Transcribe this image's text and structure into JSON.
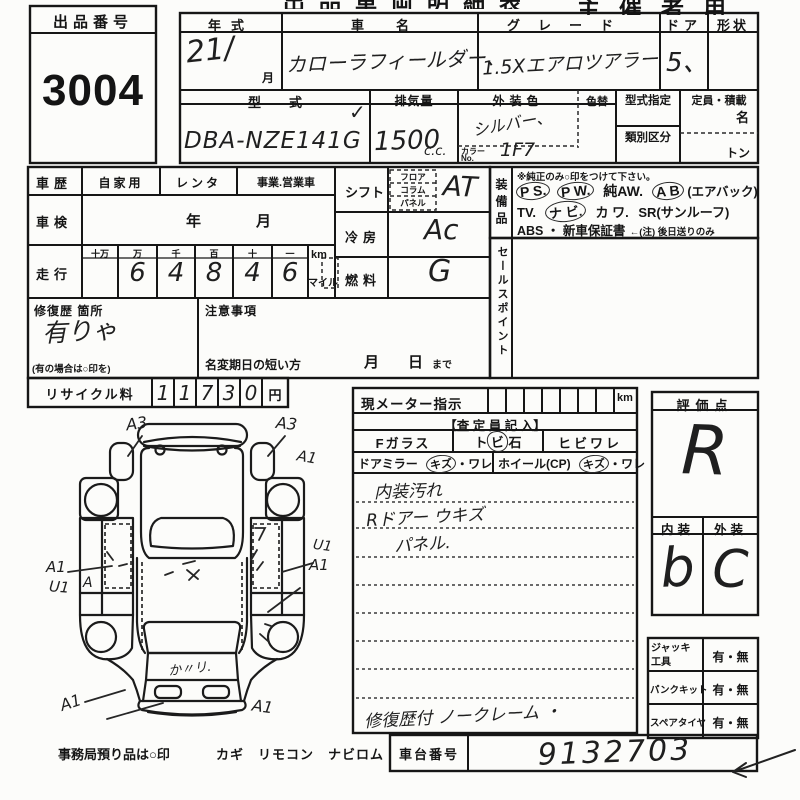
{
  "header": {
    "title_fragment": "出品車両明細表",
    "organizer_label": "主催者用",
    "exhibit": {
      "label": "出品番号",
      "number": "3004"
    }
  },
  "top": {
    "year": {
      "label": "年式",
      "value": "21/",
      "suffix": "月"
    },
    "car_name": {
      "label": "車名",
      "value": "カローラフィールダー、"
    },
    "grade": {
      "label": "グレード",
      "value": "1.5Xエアロツアラー"
    },
    "door": {
      "label": "ドア",
      "value": "5、"
    },
    "shape": {
      "label": "形状"
    },
    "model": {
      "label": "型式",
      "value": "DBA-NZE141G",
      "check": "✓"
    },
    "displacement": {
      "label": "排気量",
      "value": "1500",
      "unit": "c.c."
    },
    "ext_color": {
      "label": "外装色",
      "value": "シルバー、",
      "color_no_label_1": "カラー",
      "color_no_label_2": "No.",
      "color_no_value": "1F7"
    },
    "color_change": {
      "label": "色替"
    },
    "type_designation": {
      "label": "型式指定"
    },
    "class_division": {
      "label": "類別区分"
    },
    "capacity": {
      "label": "定員・積載",
      "persons": "名",
      "tons": "トン"
    }
  },
  "history": {
    "car_history": {
      "label": "車歴",
      "opt1": "自家用",
      "opt2": "レンタ",
      "opt3": "事業.営業車"
    },
    "inspection": {
      "label": "車検",
      "year": "年",
      "month": "月"
    },
    "mileage": {
      "label": "走行",
      "digit_labels": [
        "十万",
        "万",
        "千",
        "百",
        "十",
        "一"
      ],
      "digits": [
        "",
        "6",
        "4",
        "8",
        "4",
        "6"
      ],
      "unit_km": "km",
      "unit_mile": "マイル"
    },
    "repair": {
      "label": "修復歴 箇所",
      "value": "有りゃ",
      "note": "(有の場合は○印を)"
    },
    "caution": {
      "label": "注意事項",
      "deadline": "名変期日の短い方",
      "month": "月",
      "day": "日",
      "until": "まで"
    },
    "recycle": {
      "label": "リサイクル料",
      "digits": [
        "1",
        "1",
        "7",
        "3",
        "0"
      ],
      "unit": "円"
    }
  },
  "spec": {
    "shift": {
      "label": "シフト",
      "pos1": "フロア",
      "pos2": "コラム",
      "pos3": "パネル",
      "value": "AT"
    },
    "aircon": {
      "label": "冷房",
      "value": "Ac"
    },
    "fuel": {
      "label": "燃料",
      "value": "G"
    }
  },
  "equipment": {
    "label": "装備品",
    "note": "※純正のみ○印をつけて下さい。",
    "ps": "P S.",
    "pw": "P W.",
    "aw": "純AW.",
    "ab": "A B",
    "airbag": "(エアバック)",
    "tv": "TV.",
    "navi": "ナ ビ.",
    "kawa": "カ ワ.",
    "sr": "SR(サンルーフ)",
    "abs": "ABS ・ 新車保証書",
    "abs_note": "←(注) 後日送りのみ"
  },
  "sales_point": {
    "label": "セールスポイント"
  },
  "meter": {
    "label": "現メーター指示",
    "unit": "km",
    "inspector_header": "【査 定 員 記 入】",
    "f_glass": "Fガラス",
    "stone_pre": "ト",
    "stone_mid": "ビ",
    "stone_post": "石",
    "crack": "ヒビワレ",
    "mirror_label": "ドアミラー",
    "mirror_circled": "キズ",
    "mirror_rest": "・ワレ",
    "wheel_label": "ホイール(CP)",
    "wheel_circled": "キズ",
    "wheel_rest": "・ワレ",
    "note1": "内装汚れ",
    "note2": "Rドアー ウキズ",
    "note3": "パネル.",
    "bottom_note": "修復歴付 ノークレーム ・"
  },
  "chassis": {
    "label": "車台番号",
    "value": "9132703"
  },
  "evaluation": {
    "label": "評価点",
    "score": "R",
    "interior_label": "内装",
    "interior": "b",
    "exterior_label": "外装",
    "exterior": "C"
  },
  "accessories": {
    "jack": {
      "label": "ジャッキ工具",
      "value": "有・無"
    },
    "puncture": {
      "label": "パンクキット",
      "value": "有・無"
    },
    "spare": {
      "label": "スペアタイヤ",
      "value": "有・無"
    }
  },
  "diagram": {
    "a3_left": "A3",
    "a3_right": "A3",
    "a1_right_top": "A1",
    "a1_left": "A1",
    "u1_left": "U1",
    "a_sill": "A",
    "u1_right": "U1",
    "a1_right": "A1",
    "a1_bottom_left": "A1",
    "a1_bottom_right": "A1",
    "hatch_note": "か〃リ."
  },
  "footer": {
    "office_note": "事務局預り品は○印",
    "items": "カギ　リモコン　ナビロム"
  }
}
